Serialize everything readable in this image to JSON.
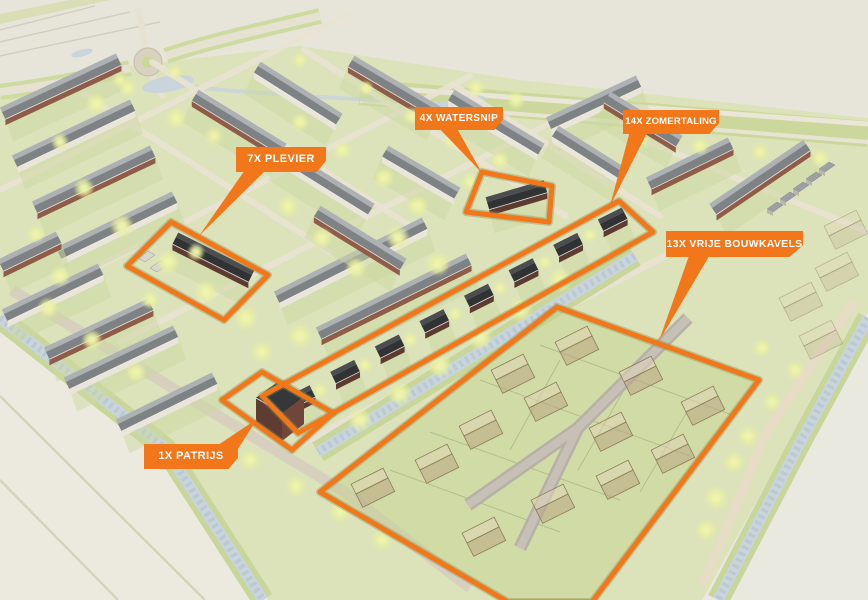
{
  "colors": {
    "accent_orange": "#f1771a",
    "callout_text": "#ffffff",
    "field_green": "#dce3ba",
    "water_blue": "#c9d4dc"
  },
  "callouts": {
    "plevier": {
      "text": "7X PLEVIER",
      "count": "7X",
      "house_type": "PLEVIER"
    },
    "watersnip": {
      "text": "4x WATERSNIP",
      "count": "4x",
      "house_type": "WATERSNIP"
    },
    "zomertaling": {
      "text": "14X ZOMERTALING",
      "count": "14X",
      "house_type": "ZOMERTALING"
    },
    "vrije_bouwkavels": {
      "text": "13X VRIJE BOUWKAVELS",
      "count": "13X",
      "house_type": "VRIJE BOUWKAVELS"
    },
    "patrijs": {
      "text": "1X PATRIJS",
      "count": "1X",
      "house_type": "PATRIJS"
    }
  }
}
